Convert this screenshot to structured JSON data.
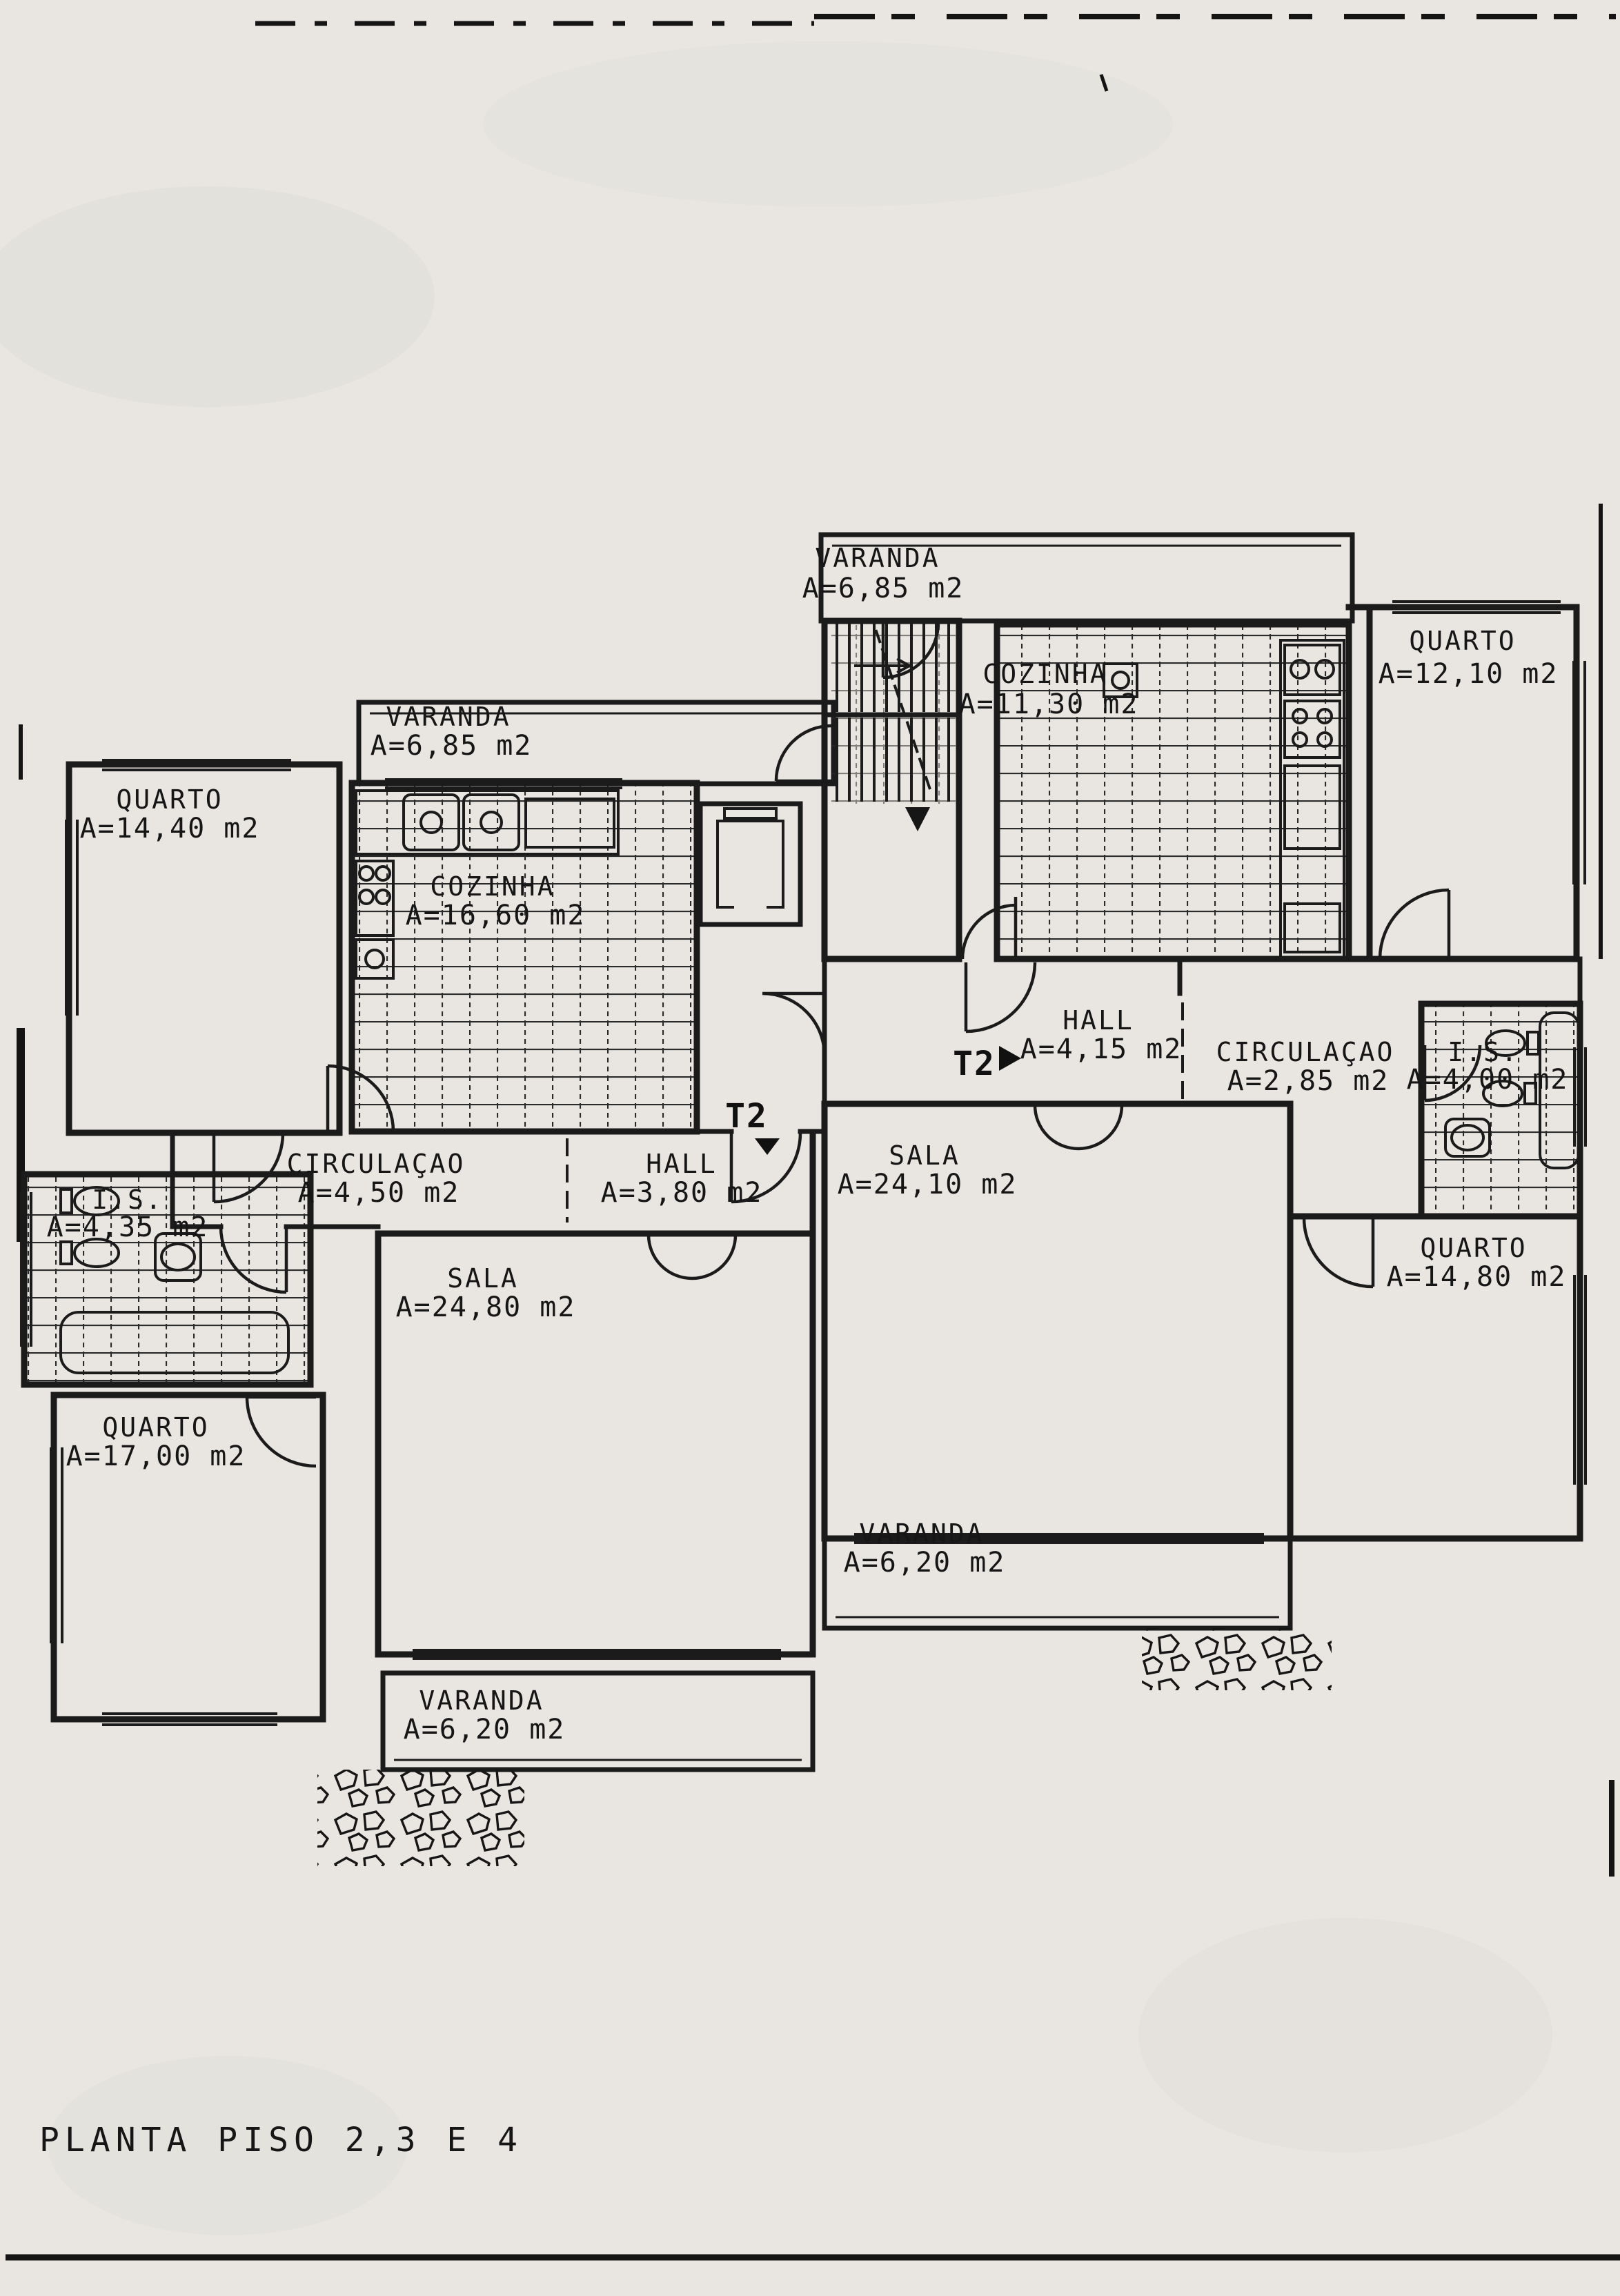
{
  "page": {
    "title": "PLANTA PISO 2,3 E 4"
  },
  "colors": {
    "ink": "#1b1b1b",
    "paper": "#e9e6e1",
    "tile_line": "#2a2a2a"
  },
  "unit_markers": [
    {
      "label": "T2",
      "arrow": "right"
    },
    {
      "label": "T2",
      "arrow": "down"
    }
  ],
  "rooms": [
    {
      "id": "varanda-top",
      "name": "VARANDA",
      "area": "A=6,85 m2"
    },
    {
      "id": "quarto-top-right",
      "name": "QUARTO",
      "area": "A=12,10 m2"
    },
    {
      "id": "cozinha-right",
      "name": "COZINHA",
      "area": "A=11,30 m2"
    },
    {
      "id": "varanda-left",
      "name": "VARANDA",
      "area": "A=6,85 m2"
    },
    {
      "id": "quarto-left-top",
      "name": "QUARTO",
      "area": "A=14,40 m2"
    },
    {
      "id": "cozinha-left",
      "name": "COZINHA",
      "area": "A=16,60 m2"
    },
    {
      "id": "hall-right",
      "name": "HALL",
      "area": "A=4,15 m2"
    },
    {
      "id": "circulacao-right",
      "name": "CIRCULAÇAO",
      "area": "A=2,85 m2"
    },
    {
      "id": "is-right",
      "name": "I.S.",
      "area": "A=4,00 m2"
    },
    {
      "id": "circulacao-left",
      "name": "CIRCULAÇAO",
      "area": "A=4,50 m2"
    },
    {
      "id": "hall-left",
      "name": "HALL",
      "area": "A=3,80 m2"
    },
    {
      "id": "sala-right",
      "name": "SALA",
      "area": "A=24,10 m2"
    },
    {
      "id": "is-left",
      "name": "I.S.",
      "area": "A=4,35 m2"
    },
    {
      "id": "sala-left",
      "name": "SALA",
      "area": "A=24,80 m2"
    },
    {
      "id": "quarto-left-bottom",
      "name": "QUARTO",
      "area": "A=17,00 m2"
    },
    {
      "id": "quarto-right-bottom",
      "name": "QUARTO",
      "area": "A=14,80 m2"
    },
    {
      "id": "varanda-right-bottom",
      "name": "VARANDA",
      "area": "A=6,20 m2"
    },
    {
      "id": "varanda-left-bottom",
      "name": "VARANDA",
      "area": "A=6,20 m2"
    }
  ]
}
